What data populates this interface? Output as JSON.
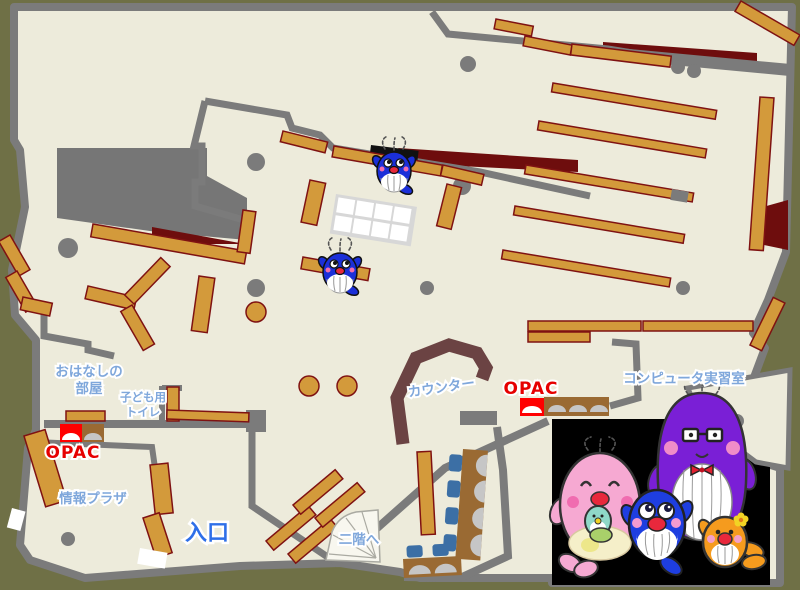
{
  "map": {
    "title": "library-first-floor-map",
    "labels": {
      "story_room_line1": "おはなしの",
      "story_room_line2": "部屋",
      "kids_toilet_line1": "子ども用",
      "kids_toilet_line2": "トイレ",
      "opac_left": "OPAC",
      "info_plaza": "情報プラザ",
      "entrance": "入口",
      "to_second_floor": "二階へ",
      "counter": "カウンター",
      "opac_right": "OPAC",
      "computer_room": "コンピュータ実習室"
    },
    "colors": {
      "background": "#6F7046",
      "floor": "#EDEBDB",
      "wall": "#7B7B7B",
      "bookshelf": "#D39A3B",
      "bookshelf_border": "#7F1212",
      "dark_red_area": "#6E0D0D",
      "counter": "#6B4343",
      "desk_brown": "#9A6A33",
      "chair_blue": "#3C6FA5",
      "label_blue": "#7FA7DB",
      "entrance_blue": "#2E6FE8",
      "opac_red": "#E60000",
      "mascot_blue": "#1B2FD8",
      "mascot_pink": "#F6A9D2",
      "mascot_purple": "#7A1FD6",
      "mascot_orange": "#F59B1E"
    }
  }
}
